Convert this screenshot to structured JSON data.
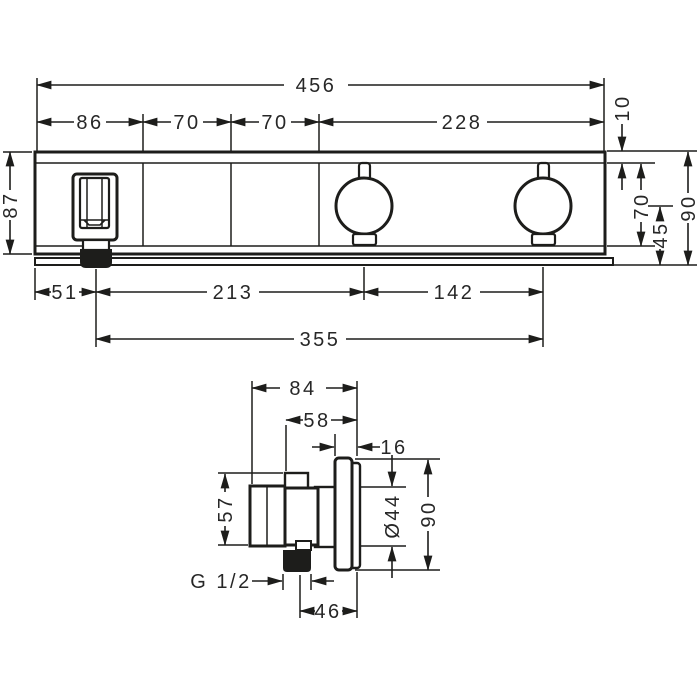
{
  "front_view": {
    "dims": {
      "total_width": "456",
      "holder_section_width": "86",
      "section_2_width": "70",
      "section_3_width": "70",
      "right_section_width": "228",
      "top_edge_offset": "10",
      "body_height": "87",
      "face_height": "70",
      "handle_center_to_bottom": "45",
      "overall_height": "90",
      "left_to_spout": "51",
      "spout_to_handle1": "213",
      "handle_spacing": "142",
      "spout_to_handle2": "355"
    }
  },
  "side_view": {
    "dims": {
      "overall_depth": "84",
      "body_depth": "58",
      "escutcheon_depth": "16",
      "body_height": "57",
      "handle_diameter": "Ø44",
      "escutcheon_height": "90",
      "connection_thread": "G 1/2",
      "axis_to_wall_face": "46"
    }
  }
}
